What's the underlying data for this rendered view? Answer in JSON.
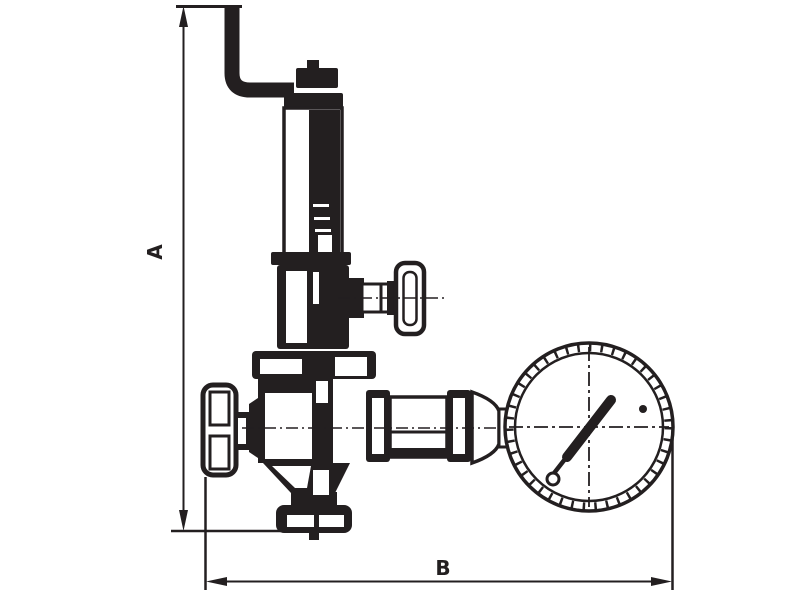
{
  "meta": {
    "title": "Valve with pressure gauge - dimensional line drawing",
    "drawing_type": "technical outline drawing"
  },
  "colors": {
    "ink": "#231f20",
    "background": "#ffffff"
  },
  "dimensions": {
    "vertical": {
      "label": "A"
    },
    "horizontal": {
      "label": "B"
    }
  },
  "components": {
    "inlet_pipe": "elbow-pipe-icon",
    "adjusting_cap": "adjusting-cap-icon",
    "spring_housing": "spring-housing-icon",
    "side_handwheel": "side-handwheel-icon",
    "left_handwheel": "inlet-handwheel-icon",
    "valve_body": "valve-body-icon",
    "outlet_fittings": "outlet-fittings-icon",
    "pressure_gauge": "pressure-gauge-icon",
    "bottom_flange": "bottom-flange-icon"
  }
}
